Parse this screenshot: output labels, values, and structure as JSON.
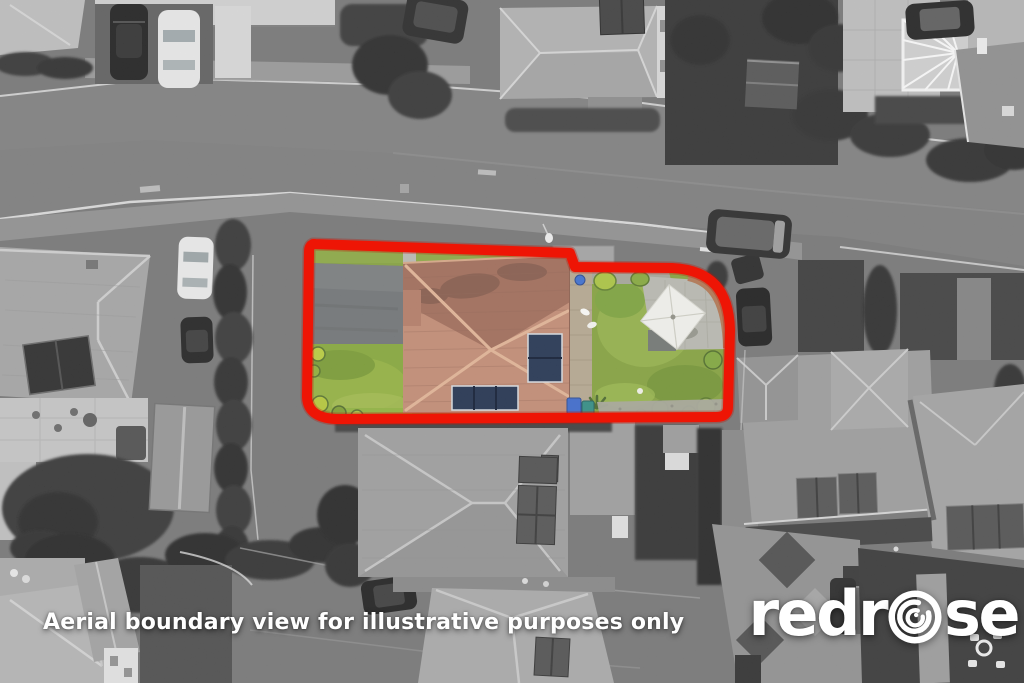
{
  "overlay": {
    "disclaimer": "Aerial boundary view for illustrative purposes only",
    "text_color": "#ffffff"
  },
  "logo": {
    "brand": "redrose",
    "text_before_icon": "redr",
    "text_after_icon": "se",
    "icon": "rose-swirl-icon",
    "color": "#ffffff"
  },
  "boundary": {
    "color": "#ee1505",
    "stroke_width_px": 10
  },
  "palette": {
    "grayscale_base": "#757575",
    "lawn_green": "#83a13b",
    "roof_terracotta": "#c28a72",
    "solar_panel_navy": "#1f2f4d",
    "driveway_tarmac": "#6f7274",
    "parasol_white": "#f2f2ee"
  }
}
